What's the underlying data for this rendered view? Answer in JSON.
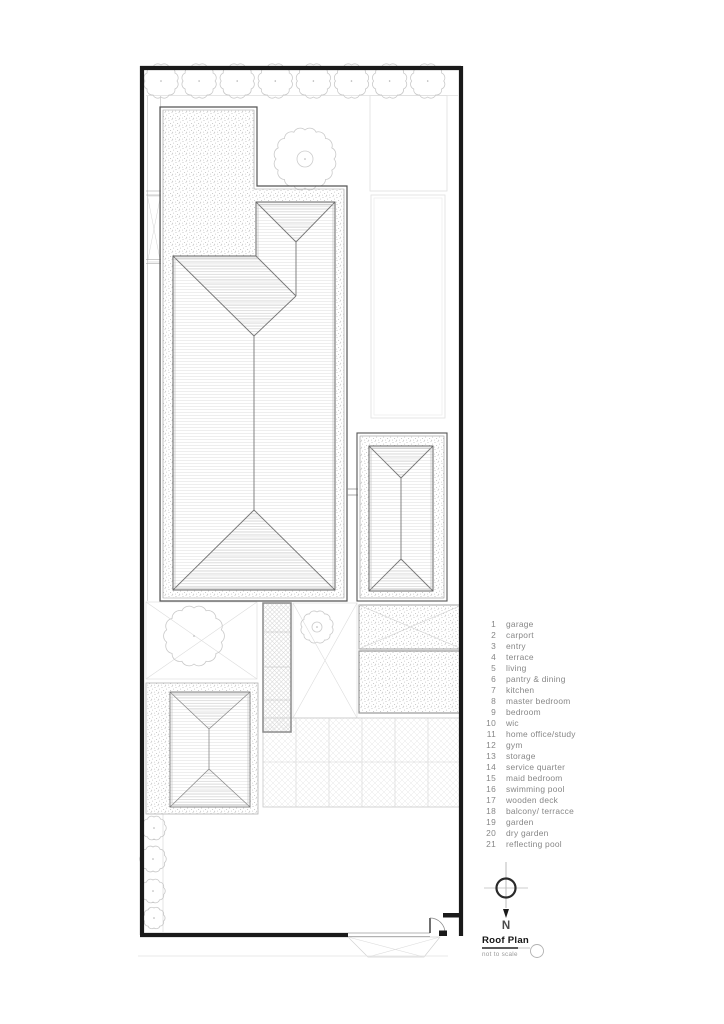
{
  "plan": {
    "title": "Roof Plan",
    "scale_note": "not to scale",
    "north_label": "N"
  },
  "legend": {
    "items": [
      {
        "num": "1",
        "label": "garage"
      },
      {
        "num": "2",
        "label": "carport"
      },
      {
        "num": "3",
        "label": "entry"
      },
      {
        "num": "4",
        "label": "terrace"
      },
      {
        "num": "5",
        "label": "living"
      },
      {
        "num": "6",
        "label": "pantry & dining"
      },
      {
        "num": "7",
        "label": "kitchen"
      },
      {
        "num": "8",
        "label": "master bedroom"
      },
      {
        "num": "9",
        "label": "bedroom"
      },
      {
        "num": "10",
        "label": "wic"
      },
      {
        "num": "11",
        "label": "home office/study"
      },
      {
        "num": "12",
        "label": "gym"
      },
      {
        "num": "13",
        "label": "storage"
      },
      {
        "num": "14",
        "label": "service quarter"
      },
      {
        "num": "15",
        "label": "maid bedroom"
      },
      {
        "num": "16",
        "label": "swimming pool"
      },
      {
        "num": "17",
        "label": "wooden deck"
      },
      {
        "num": "18",
        "label": "balcony/ terracce"
      },
      {
        "num": "19",
        "label": "garden"
      },
      {
        "num": "20",
        "label": "dry garden"
      },
      {
        "num": "21",
        "label": "reflecting pool"
      }
    ]
  },
  "colors": {
    "boundary_ink": "#1a1a1a",
    "roof_line": "#666666",
    "light_line": "#dddddd",
    "legend_text": "#878787"
  }
}
